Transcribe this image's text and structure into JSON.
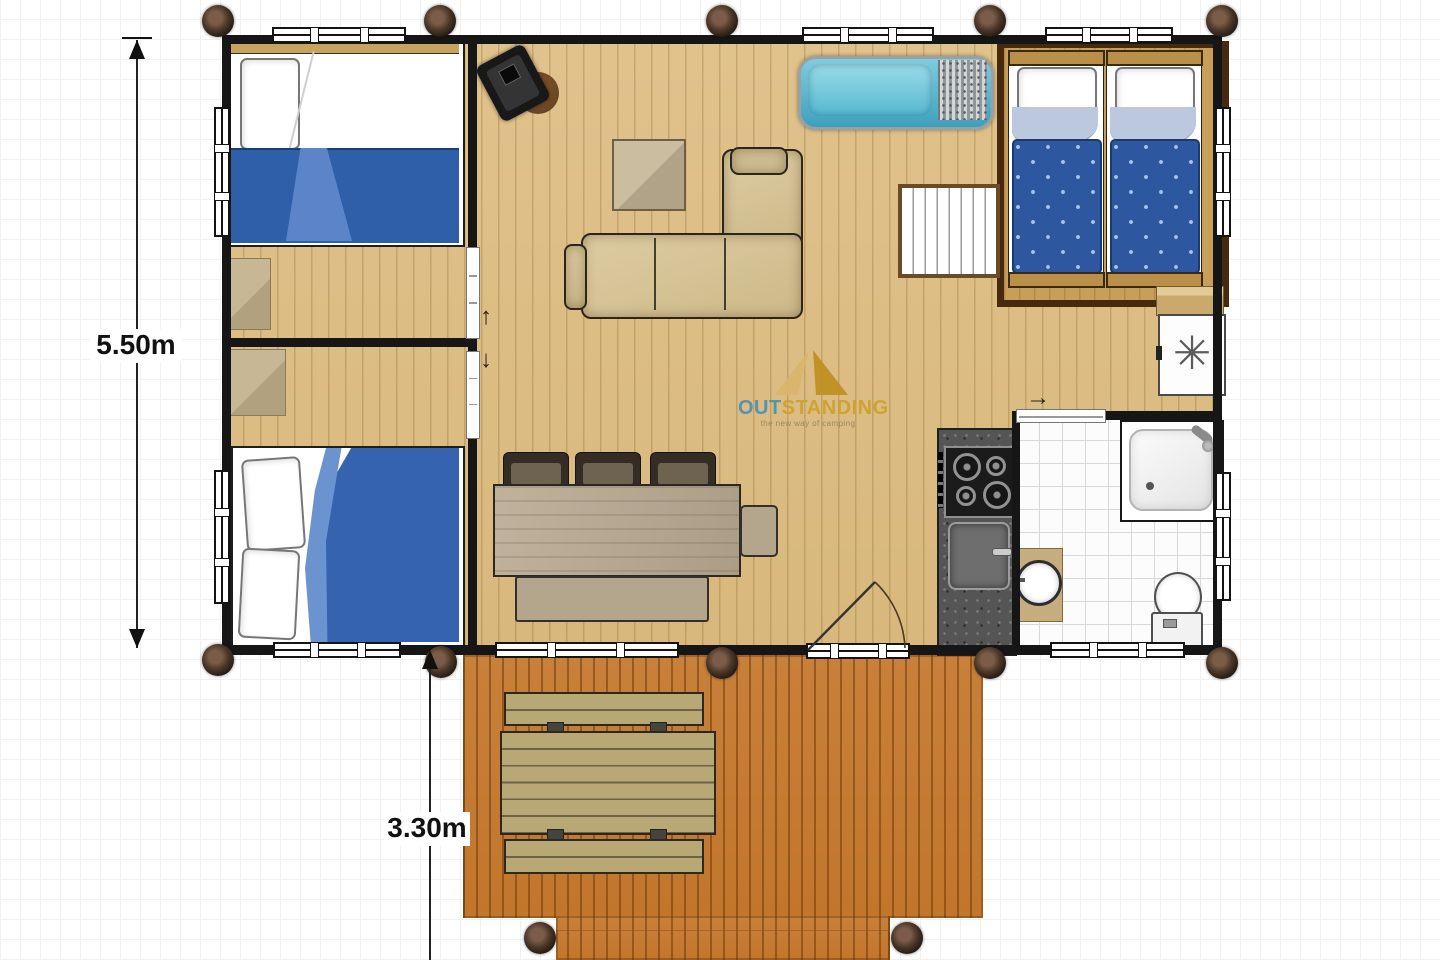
{
  "dimensions": {
    "height_label": "5.50m",
    "terrace_label": "3.30m"
  },
  "logo": {
    "part1": "OUT",
    "part2": "STANDING",
    "tagline": "the new way of camping",
    "part1_color": "#4a90b5",
    "part2_color": "#cfa12b",
    "tent_left_color": "#d9b66a",
    "tent_right_color": "#bf8f1f"
  },
  "symbols": {
    "washer": "✳",
    "slide_up": "↑",
    "slide_down": "↓",
    "slide_right": "→"
  },
  "colors": {
    "wall": "#161616",
    "floor_wood": "#dcbd84",
    "deck_wood": "#c67e33",
    "bed_blue": "#2d58a0",
    "bed_blue_light": "#5b85c8",
    "lounger_teal": "#55b8d0",
    "sofa_beige": "#d9c79d",
    "platform_brown": "#46290e"
  }
}
